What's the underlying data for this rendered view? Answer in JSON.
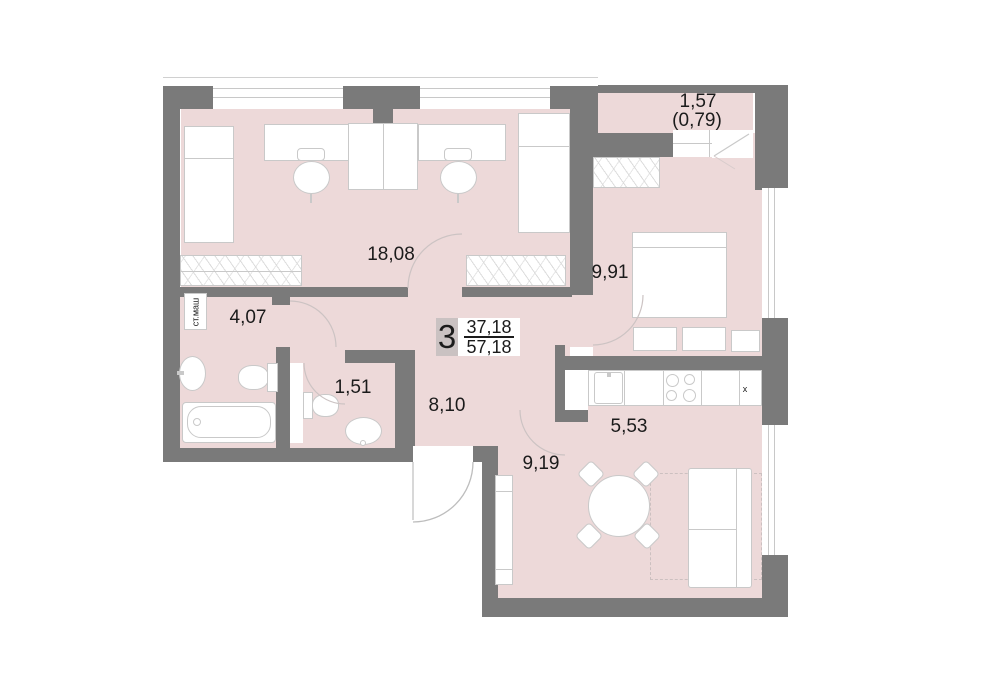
{
  "plan": {
    "unit": {
      "number": "3",
      "living_area": "37,18",
      "total_area": "57,18"
    },
    "rooms": {
      "children_room": "18,08",
      "bedroom": "9,91",
      "balcony": "1,57",
      "balcony_coeff": "(0,79)",
      "bathroom": "4,07",
      "wc": "1,51",
      "hallway": "8,10",
      "kitchen": "5,53",
      "dining": "9,19"
    },
    "annotations": {
      "washing_machine": "ст.маш",
      "vent_mark": "x"
    },
    "colors": {
      "wall": "#7a7a7a",
      "floor": "#edd9d9",
      "line": "#c9c9c9"
    }
  }
}
